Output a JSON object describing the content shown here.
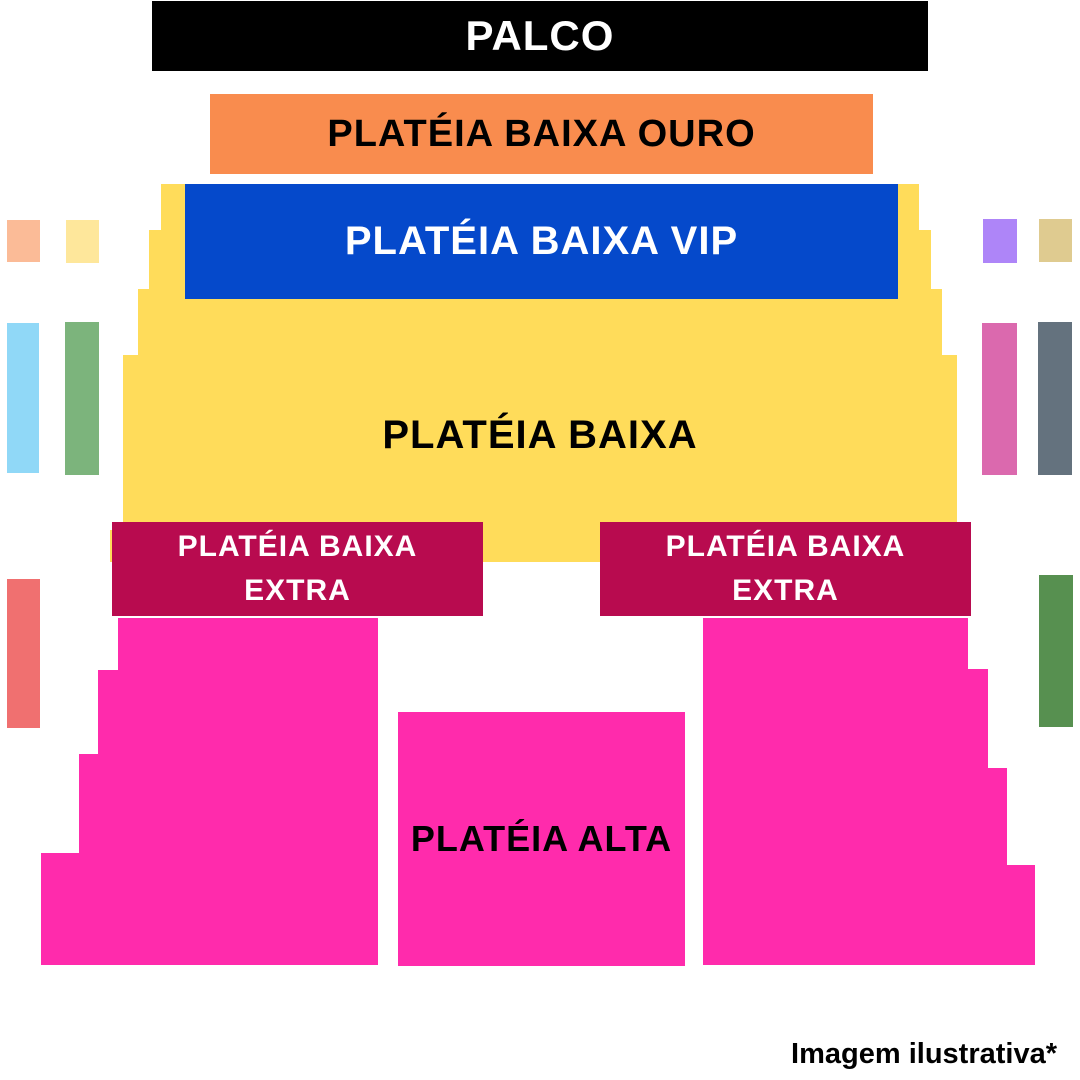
{
  "sections": {
    "palco": {
      "label": "PALCO"
    },
    "ouro": {
      "label": "PLATÉIA BAIXA OURO"
    },
    "vip": {
      "label": "PLATÉIA BAIXA VIP"
    },
    "baixa": {
      "label": "PLATÉIA BAIXA"
    },
    "extra_left": {
      "label_line1": "PLATÉIA BAIXA",
      "label_line2": "EXTRA"
    },
    "extra_right": {
      "label_line1": "PLATÉIA BAIXA",
      "label_line2": "EXTRA"
    },
    "alta": {
      "label": "PLATÉIA ALTA"
    }
  },
  "caption": "Imagem ilustrativa*",
  "colors": {
    "stage_bg": "#000000",
    "stage_text": "#FFFFFF",
    "ouro_bg": "#F98C4E",
    "ouro_text": "#000000",
    "vip_bg": "#0549CB",
    "vip_text": "#FFFFFF",
    "baixa_bg": "#FFDC5A",
    "baixa_text": "#000000",
    "extra_bg": "#B80B4F",
    "extra_text": "#FFFFFF",
    "alta_bg": "#FF2BAC",
    "alta_text": "#000000",
    "caption_text": "#000000",
    "side_left_peach": "#FBBB97",
    "side_left_cream": "#FEE79B",
    "side_left_sky": "#90D8F7",
    "side_left_green": "#7CB47C",
    "side_left_salmon": "#F07070",
    "side_right_purple": "#AE85F8",
    "side_right_tan": "#DFCB90",
    "side_right_rose": "#DB69AE",
    "side_right_gray": "#64727E",
    "side_right_green": "#579050"
  }
}
